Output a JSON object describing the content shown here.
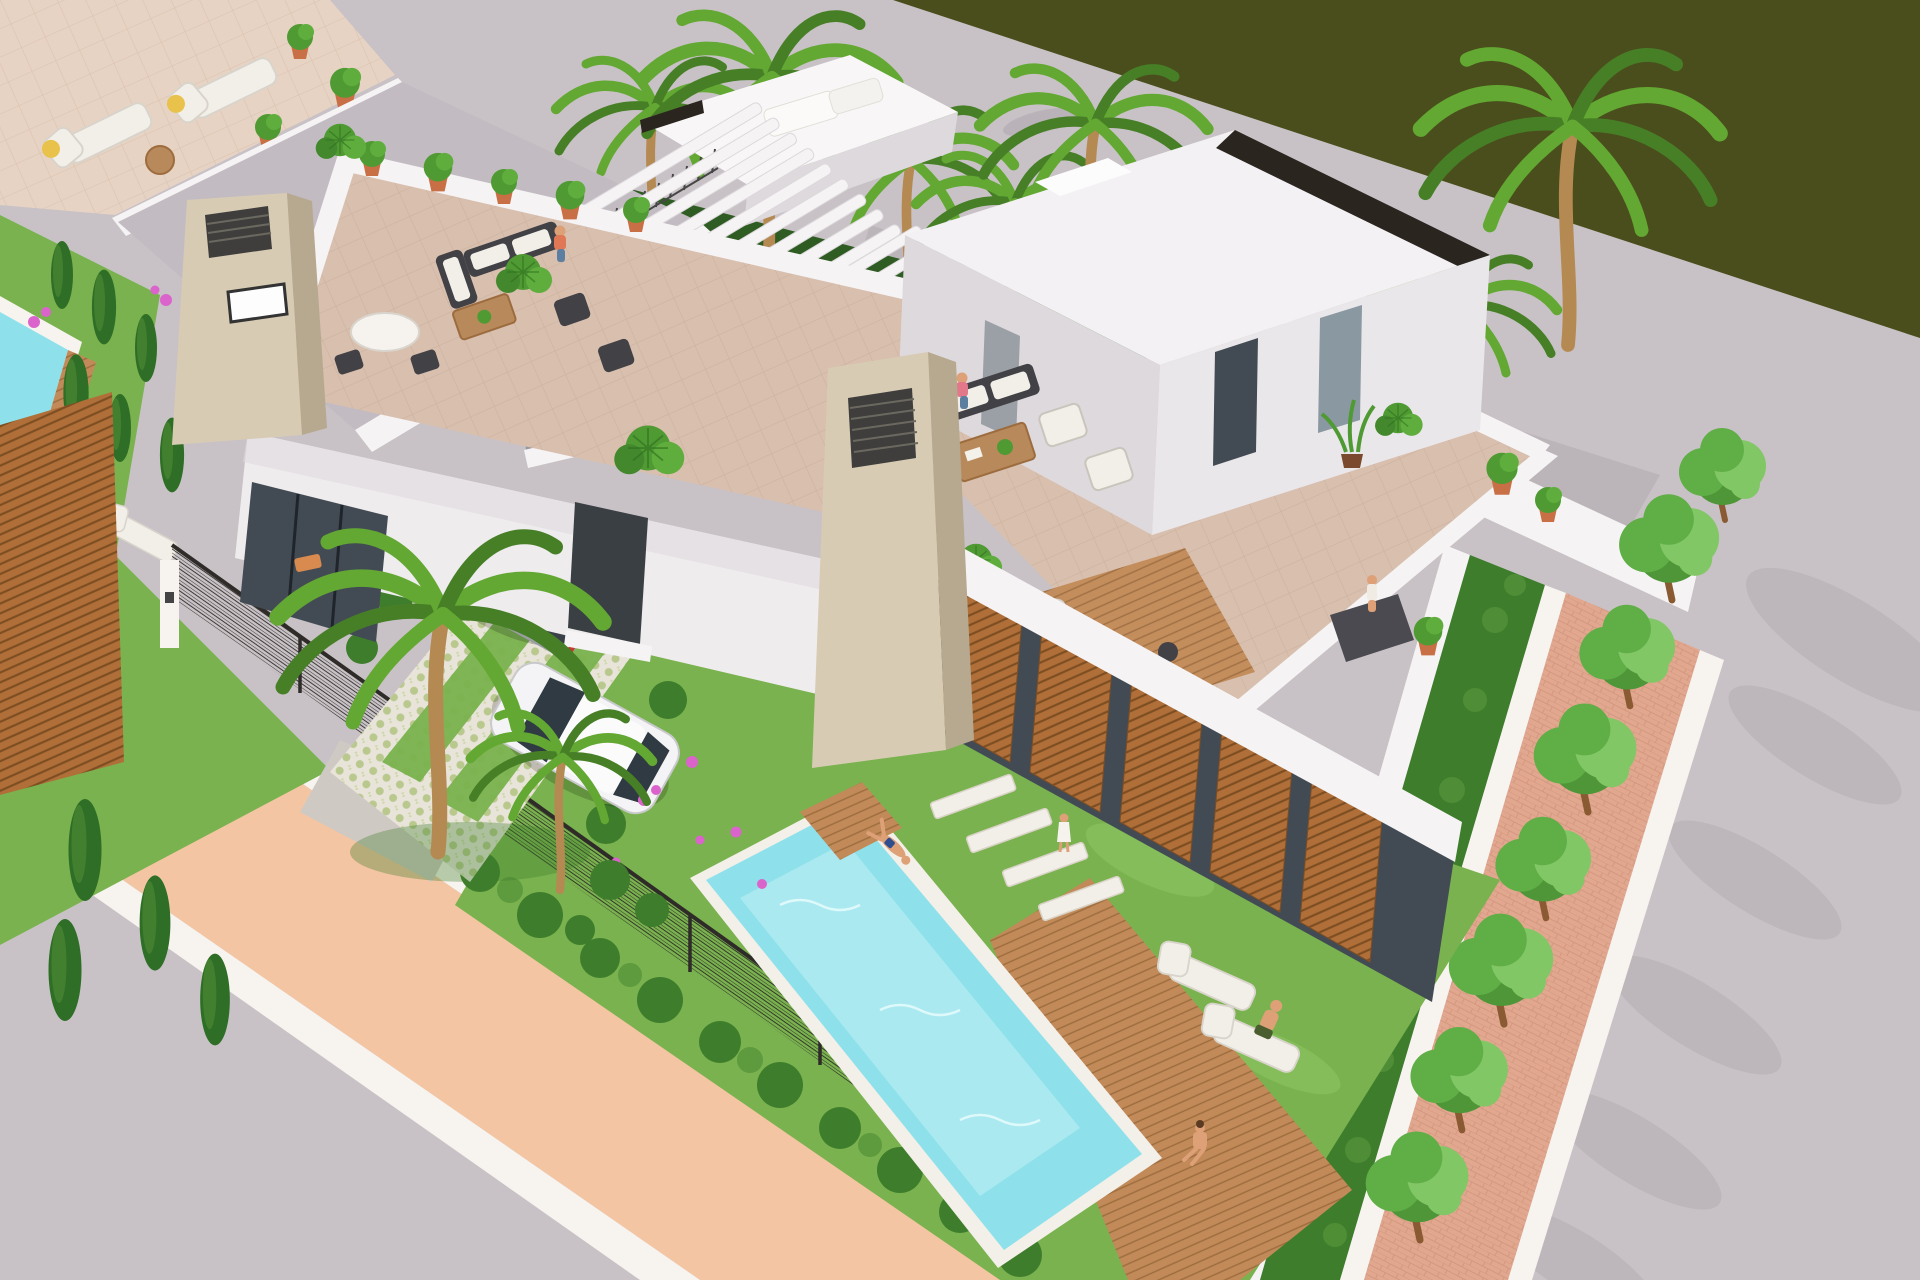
{
  "scene": {
    "type": "3d-architectural-render",
    "description": "Aerial 3D render of a modern white villa development: three flat-roofed villas with rooftop terraces and outdoor furniture, a turquoise private pool with wooden deck, bright lawns with hedges and palm trees, a driveway with a silver minivan and a white car, a salmon-coloured sidewalk and grey asphalt roads, a brick pedestrian path lined with round trees, and a dark olive-green field across the top road.",
    "time_of_day": "bright midday sun, hard shadows"
  },
  "objects": {
    "villas": 3,
    "rooftop_terraces": 3,
    "pools": 2,
    "cars": [
      "silver minivan",
      "white hatchback"
    ],
    "street_trees": 7,
    "palm_trees": 9,
    "cypresses": 10,
    "sun_loungers": 7,
    "people": 11,
    "pergolas": 2,
    "stone_chimneys": 2,
    "wood_louver_panels": 6
  },
  "palette": {
    "field_olive": "#4a4e1c",
    "road": "#c8c2c6",
    "road_shadow": "#8f8791",
    "sidewalk": "#f4c5a3",
    "curb": "#f7f3ef",
    "brick_path": "#e2a78f",
    "brick_line": "#c98b74",
    "grass": "#79b24e",
    "grass_light": "#8fc763",
    "hedge": "#3e7d2c",
    "hedge_light": "#55923a",
    "cypress": "#2f6e26",
    "tree": "#5fae46",
    "tree_light": "#82c765",
    "palm": "#63a832",
    "palm_dark": "#477f27",
    "trunk": "#b58a52",
    "pool": "#8ee1ea",
    "pool_light": "#c2f0f4",
    "deck": "#c28a58",
    "deck_dark": "#9c6c3e",
    "wall": "#f5f3f4",
    "wall_mid": "#ded9dd",
    "wall_shade": "#c2bcc2",
    "wall_dark": "#a9a2a9",
    "stone": "#d8cbb4",
    "stone_side": "#b7a98f",
    "grille": "#3f3e3c",
    "trim_black": "#2b2520",
    "glass": "#424b54",
    "glass_light": "#8a98a2",
    "louver": "#b06f38",
    "louver_dark": "#7e4e23",
    "tile": "#d8bfae",
    "tile_light": "#e7d3c3",
    "furn_dark": "#414146",
    "furn_white": "#f2efe9",
    "wood": "#b8895a",
    "skin": "#dda077",
    "fence": "#2e2b28",
    "flower": "#db64cc",
    "hat": "#e8c24a",
    "mat": "#4a4a50",
    "vine": "#2f5c22",
    "vine_light": "#47792f"
  }
}
